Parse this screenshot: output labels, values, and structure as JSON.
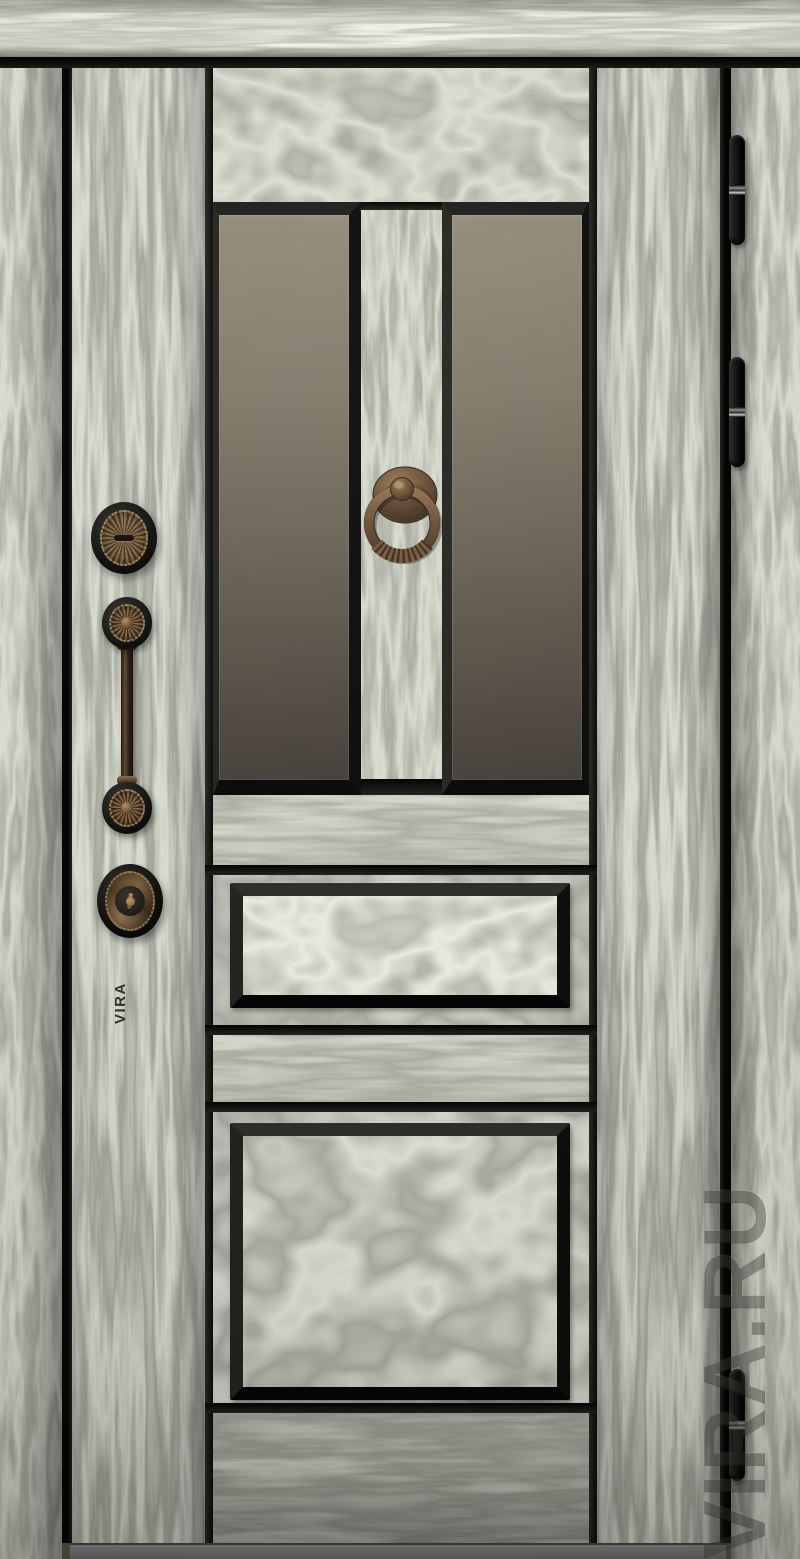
{
  "photo": {
    "subject": "steel entry door with woodgrain finish, two glass panes and two raised panels",
    "glass_panes": 2,
    "raised_panels": 2,
    "hinge_count": 3
  },
  "branding": {
    "stamp_text": "VIRA",
    "watermark_text": "VIRA.RU"
  },
  "hardware": {
    "knocker": "bronze-ring-knocker",
    "escutcheon": "sunburst-keyhole-escutcheon",
    "handle": "vertical-pull-handle",
    "lock": "cylinder-deadbolt",
    "hinges": "black-barrel-hinges"
  },
  "colors": {
    "wood_base": "#7b7c6c",
    "wood_light": "#c9c8b6",
    "wood_dark": "#4e4f43",
    "frame_top_light": "#a9a896",
    "trim_black": "#131312",
    "glass_top": "#948c7b",
    "glass_bottom": "#45403a",
    "bronze": "#7a5f43",
    "bronze_light": "#a0815a",
    "bronze_dark": "#3c2d1f",
    "hinge_black": "#111110",
    "threshold_gray": "#7d7d7b"
  }
}
